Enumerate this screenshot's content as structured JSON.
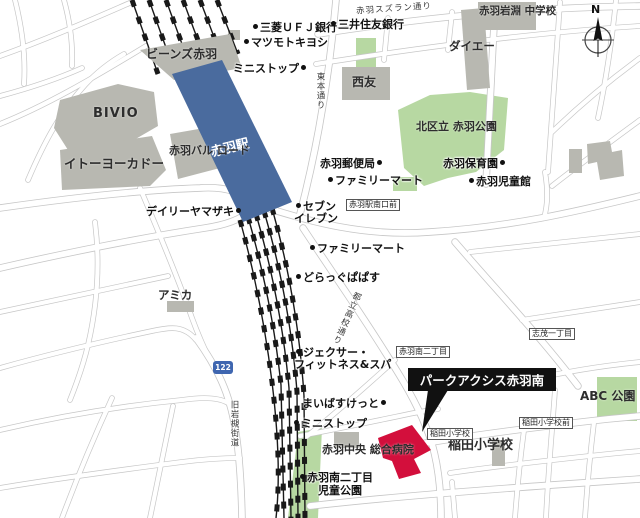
{
  "colors": {
    "station_blue": "#4a6b9e",
    "park_green": "#b7d8a2",
    "building_gray": "#b8b8b1",
    "property_red": "#d30f3c",
    "callout_black": "#111111",
    "railway_black": "#191919",
    "road_gray": "#c6c6c6",
    "route_badge_blue": "#3f66b0"
  },
  "map": {
    "compass": "N",
    "route_badge": "122",
    "station_label": "赤羽駅",
    "callout_label": "パークアクシス赤羽南",
    "streets": {
      "suzuran": "赤羽スズラン通り",
      "higashihon": "東本通り",
      "koko": "都立高校通り",
      "iwatsuki": "旧岩槻街道"
    },
    "bus_stops": {
      "minamiguchi": "赤羽駅南口前",
      "shimo1": "志茂一丁目",
      "minami2": "赤羽南二丁目",
      "inada": "稲田小学校",
      "inada_mae": "稲田小学校前"
    },
    "places": {
      "beans": "ビーンズ赤羽",
      "bivio": "BIVIO",
      "itoyokado": "イトーヨーカドー",
      "bar_road_l1": "赤羽バル",
      "bar_road_l2": "ロード",
      "seiyu": "西友",
      "daiei": "ダイエー",
      "iwabuchi_jhs_l1": "赤羽岩淵",
      "iwabuchi_jhs_l2": "中学校",
      "park_kita_l1": "北区立",
      "park_kita_l2": "赤羽公園",
      "amica": "アミカ",
      "hospital_l1": "赤羽中央",
      "hospital_l2": "総合病院",
      "inada_school": "稲田小学校",
      "abc_park": "ABC 公園"
    },
    "pois": {
      "mufg": "三菱ＵＦＪ銀行",
      "matsukiyo": "マツモトキヨシ",
      "smbc": "三井住友銀行",
      "ministop_n": "ミニストップ",
      "post_office": "赤羽郵便局",
      "famima_n": "ファミリーマート",
      "hoikuen": "赤羽保育園",
      "jidokan": "赤羽児童館",
      "daily_yamazaki": "デイリーヤマザキ",
      "seven_l1": "セブン",
      "seven_l2": "イレブン",
      "famima_s": "ファミリーマート",
      "papasu": "どらっぐぱぱす",
      "jexer_l1": "ジェクサー・",
      "jexer_l2": "フィットネス&スパ",
      "maibasket": "まいばすけっと",
      "ministop_s": "ミニストップ",
      "jido_park_l1": "赤羽南二丁目",
      "jido_park_l2": "児童公園"
    }
  }
}
